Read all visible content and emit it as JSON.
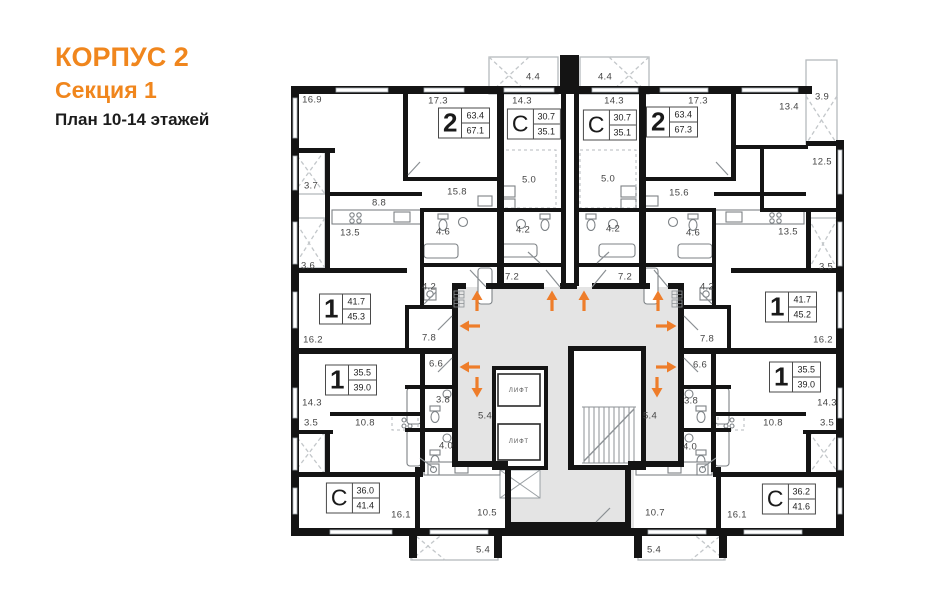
{
  "header": {
    "building": "КОРПУС 2",
    "section": "Секция 1",
    "plan": "План 10-14 этажей"
  },
  "colors": {
    "accent": "#f0861d",
    "wall": "#141414",
    "corridor": "#e4e4e4",
    "arrow": "#ee7d2a"
  },
  "core": {
    "lift_label": "ЛИФТ",
    "lifts": [
      {
        "x": 519,
        "y": 391
      },
      {
        "x": 519,
        "y": 442
      }
    ]
  },
  "apartments": [
    {
      "type": "2",
      "area1": "63.4",
      "area2": "67.1",
      "x": 464,
      "y": 123
    },
    {
      "type": "С",
      "area1": "30.7",
      "area2": "35.1",
      "x": 534,
      "y": 124
    },
    {
      "type": "С",
      "area1": "30.7",
      "area2": "35.1",
      "x": 610,
      "y": 125
    },
    {
      "type": "2",
      "area1": "63.4",
      "area2": "67.3",
      "x": 672,
      "y": 122
    },
    {
      "type": "1",
      "area1": "41.7",
      "area2": "45.3",
      "x": 345,
      "y": 309
    },
    {
      "type": "1",
      "area1": "41.7",
      "area2": "45.2",
      "x": 791,
      "y": 307
    },
    {
      "type": "1",
      "area1": "35.5",
      "area2": "39.0",
      "x": 351,
      "y": 380
    },
    {
      "type": "1",
      "area1": "35.5",
      "area2": "39.0",
      "x": 795,
      "y": 377
    },
    {
      "type": "С",
      "area1": "36.0",
      "area2": "41.4",
      "x": 353,
      "y": 498
    },
    {
      "type": "С",
      "area1": "36.2",
      "area2": "41.6",
      "x": 789,
      "y": 499
    }
  ],
  "rooms": [
    {
      "label": "16.9",
      "x": 312,
      "y": 100
    },
    {
      "label": "17.3",
      "x": 438,
      "y": 101
    },
    {
      "label": "14.3",
      "x": 522,
      "y": 101
    },
    {
      "label": "4.4",
      "x": 533,
      "y": 77
    },
    {
      "label": "4.4",
      "x": 605,
      "y": 77
    },
    {
      "label": "14.3",
      "x": 614,
      "y": 101
    },
    {
      "label": "17.3",
      "x": 698,
      "y": 101
    },
    {
      "label": "13.4",
      "x": 789,
      "y": 107
    },
    {
      "label": "3.9",
      "x": 822,
      "y": 97
    },
    {
      "label": "5.0",
      "x": 529,
      "y": 180
    },
    {
      "label": "5.0",
      "x": 608,
      "y": 179
    },
    {
      "label": "15.8",
      "x": 457,
      "y": 192
    },
    {
      "label": "15.6",
      "x": 679,
      "y": 193
    },
    {
      "label": "12.5",
      "x": 822,
      "y": 162
    },
    {
      "label": "3.7",
      "x": 311,
      "y": 186
    },
    {
      "label": "8.8",
      "x": 379,
      "y": 203
    },
    {
      "label": "13.5",
      "x": 350,
      "y": 233
    },
    {
      "label": "4.6",
      "x": 443,
      "y": 232
    },
    {
      "label": "4.6",
      "x": 693,
      "y": 233
    },
    {
      "label": "13.5",
      "x": 788,
      "y": 232
    },
    {
      "label": "3.6",
      "x": 308,
      "y": 266
    },
    {
      "label": "4.2",
      "x": 523,
      "y": 230
    },
    {
      "label": "4.2",
      "x": 613,
      "y": 229
    },
    {
      "label": "4.2",
      "x": 429,
      "y": 287
    },
    {
      "label": "4.2",
      "x": 707,
      "y": 287
    },
    {
      "label": "7.2",
      "x": 512,
      "y": 277
    },
    {
      "label": "7.2",
      "x": 625,
      "y": 277
    },
    {
      "label": "3.5",
      "x": 826,
      "y": 267
    },
    {
      "label": "16.2",
      "x": 313,
      "y": 340
    },
    {
      "label": "7.8",
      "x": 429,
      "y": 338
    },
    {
      "label": "7.8",
      "x": 707,
      "y": 339
    },
    {
      "label": "16.2",
      "x": 823,
      "y": 340
    },
    {
      "label": "6.6",
      "x": 436,
      "y": 364
    },
    {
      "label": "6.6",
      "x": 700,
      "y": 365
    },
    {
      "label": "14.3",
      "x": 312,
      "y": 403
    },
    {
      "label": "3.8",
      "x": 443,
      "y": 400
    },
    {
      "label": "3.8",
      "x": 691,
      "y": 401
    },
    {
      "label": "14.3",
      "x": 827,
      "y": 403
    },
    {
      "label": "3.5",
      "x": 311,
      "y": 423
    },
    {
      "label": "10.8",
      "x": 365,
      "y": 423
    },
    {
      "label": "10.8",
      "x": 773,
      "y": 423
    },
    {
      "label": "3.5",
      "x": 827,
      "y": 423
    },
    {
      "label": "4.0",
      "x": 446,
      "y": 446
    },
    {
      "label": "4.0",
      "x": 690,
      "y": 447
    },
    {
      "label": "5.4",
      "x": 485,
      "y": 416
    },
    {
      "label": "5.4",
      "x": 650,
      "y": 416
    },
    {
      "label": "16.1",
      "x": 401,
      "y": 515
    },
    {
      "label": "10.5",
      "x": 487,
      "y": 513
    },
    {
      "label": "10.7",
      "x": 655,
      "y": 513
    },
    {
      "label": "16.1",
      "x": 737,
      "y": 515
    },
    {
      "label": "5.4",
      "x": 483,
      "y": 550
    },
    {
      "label": "5.4",
      "x": 654,
      "y": 550
    }
  ],
  "arrows": [
    {
      "dir": "up",
      "x": 477,
      "y": 301
    },
    {
      "dir": "up",
      "x": 552,
      "y": 301
    },
    {
      "dir": "up",
      "x": 584,
      "y": 301
    },
    {
      "dir": "up",
      "x": 658,
      "y": 301
    },
    {
      "dir": "left",
      "x": 470,
      "y": 326
    },
    {
      "dir": "right",
      "x": 666,
      "y": 326
    },
    {
      "dir": "left",
      "x": 470,
      "y": 367
    },
    {
      "dir": "right",
      "x": 666,
      "y": 367
    },
    {
      "dir": "down",
      "x": 477,
      "y": 387
    },
    {
      "dir": "down",
      "x": 657,
      "y": 387
    }
  ]
}
